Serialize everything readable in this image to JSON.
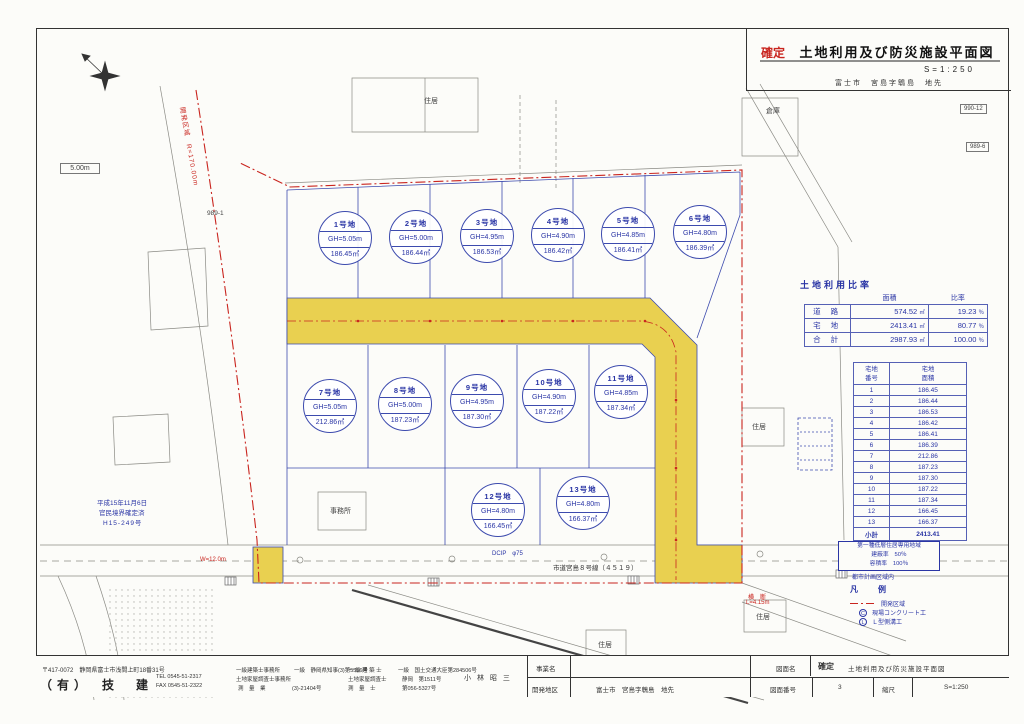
{
  "header": {
    "status": "確定",
    "title": "土地利用及び防災施設平面図",
    "scale": "S=1:250",
    "location": "富士市　宮島字鵯島　地先"
  },
  "land_use": {
    "title": "土地利用比率",
    "col_area": "面積",
    "col_ratio": "比率",
    "unit_area": "㎡",
    "unit_ratio": "％",
    "rows": [
      {
        "label": "道 路",
        "area": "574.52",
        "ratio": "19.23"
      },
      {
        "label": "宅 地",
        "area": "2413.41",
        "ratio": "80.77"
      },
      {
        "label": "合 計",
        "area": "2987.93",
        "ratio": "100.00"
      }
    ]
  },
  "lot_table": {
    "h_no1": "宅地",
    "h_no2": "番号",
    "h_a1": "宅地",
    "h_a2": "面積",
    "rows": [
      {
        "no": "1",
        "area": "186.45"
      },
      {
        "no": "2",
        "area": "186.44"
      },
      {
        "no": "3",
        "area": "186.53"
      },
      {
        "no": "4",
        "area": "186.42"
      },
      {
        "no": "5",
        "area": "186.41"
      },
      {
        "no": "6",
        "area": "186.39"
      },
      {
        "no": "7",
        "area": "212.86"
      },
      {
        "no": "8",
        "area": "187.23"
      },
      {
        "no": "9",
        "area": "187.30"
      },
      {
        "no": "10",
        "area": "187.22"
      },
      {
        "no": "11",
        "area": "187.34"
      },
      {
        "no": "12",
        "area": "166.45"
      },
      {
        "no": "13",
        "area": "166.37"
      }
    ],
    "total_label": "小計",
    "total_value": "2413.41"
  },
  "lots": [
    {
      "name": "1号地",
      "gh": "GH=5.05m",
      "area": "186.45㎡"
    },
    {
      "name": "2号地",
      "gh": "GH=5.00m",
      "area": "186.44㎡"
    },
    {
      "name": "3号地",
      "gh": "GH=4.95m",
      "area": "186.53㎡"
    },
    {
      "name": "4号地",
      "gh": "GH=4.90m",
      "area": "186.42㎡"
    },
    {
      "name": "5号地",
      "gh": "GH=4.85m",
      "area": "186.41㎡"
    },
    {
      "name": "6号地",
      "gh": "GH=4.80m",
      "area": "186.39㎡"
    },
    {
      "name": "7号地",
      "gh": "GH=5.05m",
      "area": "212.86㎡"
    },
    {
      "name": "8号地",
      "gh": "GH=5.00m",
      "area": "187.23㎡"
    },
    {
      "name": "9号地",
      "gh": "GH=4.95m",
      "area": "187.30㎡"
    },
    {
      "name": "10号地",
      "gh": "GH=4.90m",
      "area": "187.22㎡"
    },
    {
      "name": "11号地",
      "gh": "GH=4.85m",
      "area": "187.34㎡"
    },
    {
      "name": "12号地",
      "gh": "GH=4.80m",
      "area": "166.45㎡"
    },
    {
      "name": "13号地",
      "gh": "GH=4.80m",
      "area": "166.37㎡"
    }
  ],
  "labels": {
    "date": "平成15年11月6日",
    "kanmin": "官民境界確定済",
    "caseno": "H15-249号",
    "curve": "開発区域　R=170.00m",
    "box5m": "5.00m",
    "p990_12": "990-12",
    "p989_6": "989-6",
    "p989_1": "989-1",
    "souko": "倉庫",
    "jukyo": "住居",
    "jimusho": "事務所",
    "road_name": "市道宮島８号線（４５１９）",
    "pipe": "DCIP　φ75",
    "red_w": "W=12.0m",
    "red_l1": "横　断",
    "red_l2": "L=4.15m"
  },
  "zoning": {
    "l1": "第一種低層住居専用地域",
    "l2": "建蔽率　50％",
    "l3": "容積率　100％",
    "note": "都市計画区域内"
  },
  "legend": {
    "title": "凡　例",
    "item1": "開発区域",
    "sym2": "C",
    "item2": "現場コンクリート工",
    "sym3": "L",
    "item3": "Ｌ型側溝工"
  },
  "footer": {
    "postal": "〒417-0072　静岡県富士市浅間上町18番31号",
    "company": "（有）　技　建",
    "tel": "TEL 0545-51-2317",
    "fax": "FAX 0545-51-2322",
    "office1": "一級建築士事務所",
    "office1_lic": "一級　静岡県知事(3)第5556号",
    "office2": "土地家屋調査士事務所",
    "office3": "測　量　業",
    "office3_lic": "(3)-21404号",
    "qual1": "一 級 建 築 士",
    "qual1_lic": "一級　国土交通大臣第284506号",
    "qual2": "土地家屋調査士",
    "qual2_lic": "静岡　第1511号",
    "qual3": "測　量　士",
    "qual3_lic": "第056-5327号",
    "engineer": "小 林 昭 三",
    "project_label": "事業名",
    "district_label": "開発地区",
    "district_value": "富士市　宮島字鵯島　地先",
    "drawing_label": "図面名",
    "drawing_status": "確定",
    "drawing_value": "土地利用及び防災施設平面図",
    "number_label": "図面番号",
    "number_value": "3",
    "scale_label": "縮尺",
    "scale_value": "S=1:250"
  }
}
